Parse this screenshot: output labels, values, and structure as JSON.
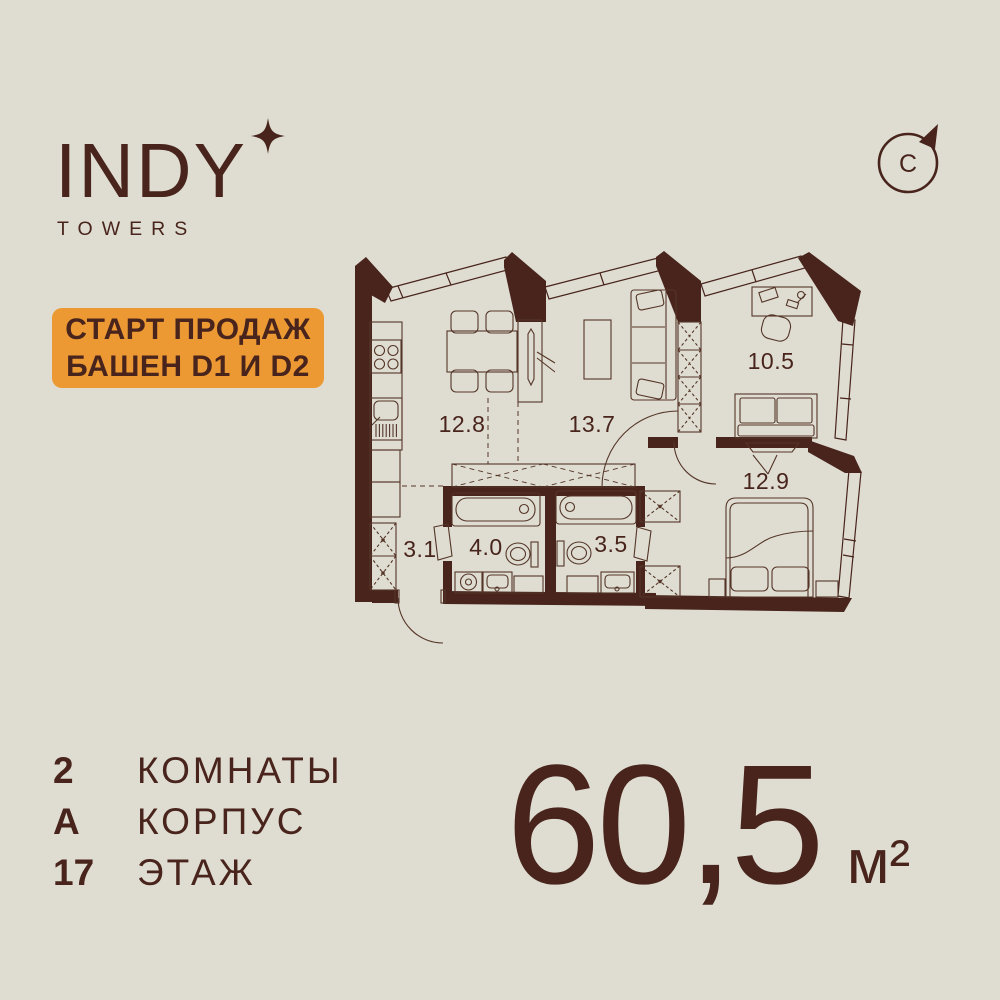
{
  "header": {
    "logo": "INDY",
    "logo_sub": "TOWERS",
    "compass_letter": "С"
  },
  "badge": {
    "line1": "СТАРТ ПРОДАЖ",
    "line2": "БАШЕН D1 И D2"
  },
  "floorplan": {
    "rooms": [
      {
        "name": "kitchen",
        "area": "12.8"
      },
      {
        "name": "living",
        "area": "13.7"
      },
      {
        "name": "office",
        "area": "10.5"
      },
      {
        "name": "bedroom",
        "area": "12.9"
      },
      {
        "name": "hallway",
        "area": "3.1"
      },
      {
        "name": "bathroom-1",
        "area": "4.0"
      },
      {
        "name": "bathroom-2",
        "area": "3.5"
      }
    ]
  },
  "details": {
    "rows": [
      {
        "value": "2",
        "label": "КОМНАТЫ"
      },
      {
        "value": "А",
        "label": "КОРПУС"
      },
      {
        "value": "17",
        "label": "ЭТАЖ"
      }
    ]
  },
  "total_area": {
    "value": "60,5",
    "unit": "м²"
  },
  "colors": {
    "background": "#DFDDD1",
    "ink": "#48241C",
    "furniture_line": "#543528",
    "accent_orange": "#EC9933"
  }
}
